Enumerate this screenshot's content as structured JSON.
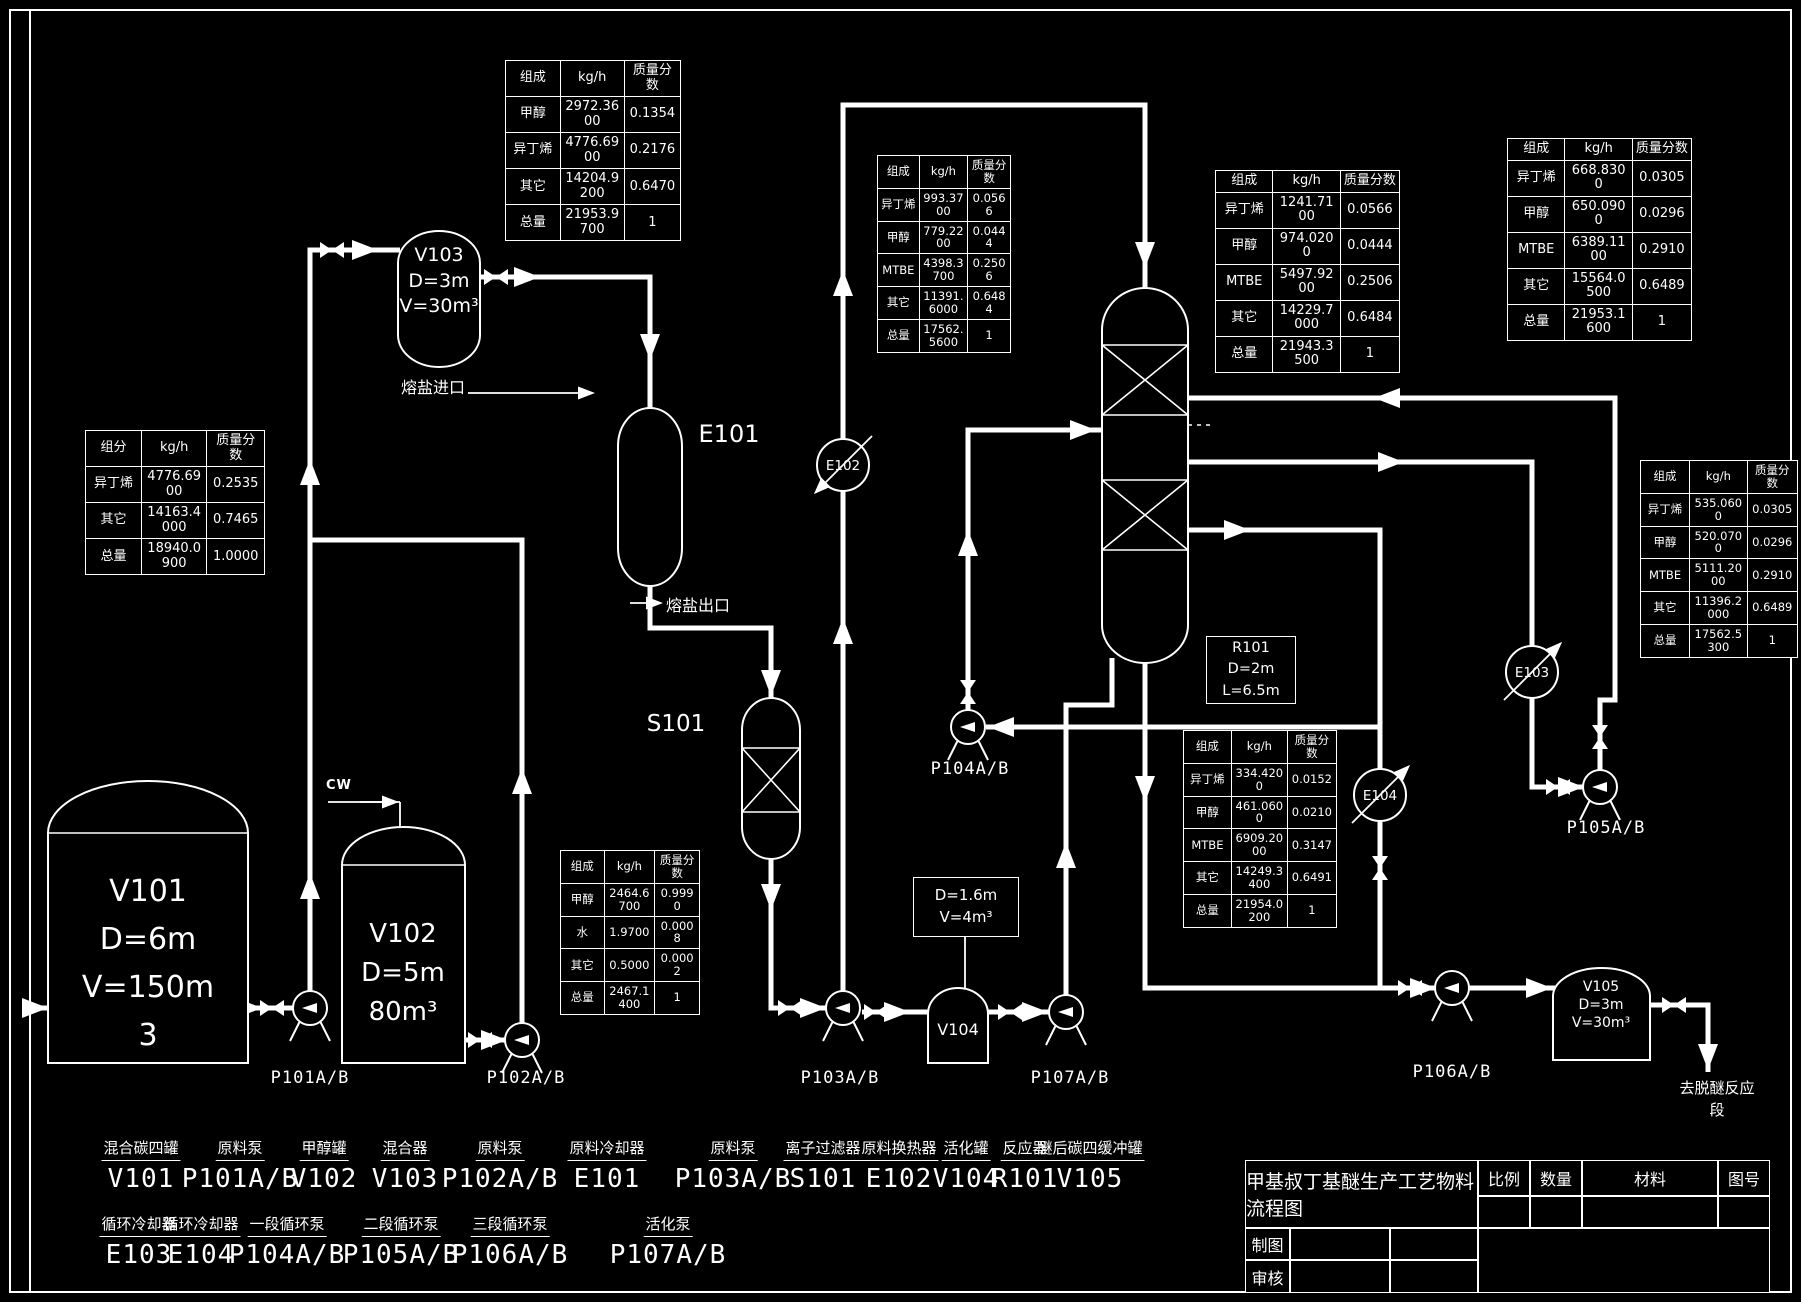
{
  "colors": {
    "background": "#000000",
    "line": "#ffffff"
  },
  "tables": {
    "top_center": {
      "headers": [
        "组成",
        "kg/h",
        "质量分数"
      ],
      "rows": [
        [
          "甲醇",
          "2972.3600",
          "0.1354"
        ],
        [
          "异丁烯",
          "4776.6900",
          "0.2176"
        ],
        [
          "其它",
          "14204.9200",
          "0.6470"
        ],
        [
          "总量",
          "21953.9700",
          "1"
        ]
      ]
    },
    "e102_stream": {
      "headers": [
        "组成",
        "kg/h",
        "质量分数"
      ],
      "rows": [
        [
          "异丁烯",
          "993.3700",
          "0.0566"
        ],
        [
          "甲醇",
          "779.2200",
          "0.0444"
        ],
        [
          "MTBE",
          "4398.3700",
          "0.2506"
        ],
        [
          "其它",
          "11391.6000",
          "0.6484"
        ],
        [
          "总量",
          "17562.5600",
          "1"
        ]
      ]
    },
    "r101_feed": {
      "headers": [
        "组成",
        "kg/h",
        "质量分数"
      ],
      "rows": [
        [
          "异丁烯",
          "1241.7100",
          "0.0566"
        ],
        [
          "甲醇",
          "974.0200",
          "0.0444"
        ],
        [
          "MTBE",
          "5497.9200",
          "0.2506"
        ],
        [
          "其它",
          "14229.7000",
          "0.6484"
        ],
        [
          "总量",
          "21943.3500",
          "1"
        ]
      ]
    },
    "top_right": {
      "headers": [
        "组成",
        "kg/h",
        "质量分数"
      ],
      "rows": [
        [
          "异丁烯",
          "668.8300",
          "0.0305"
        ],
        [
          "甲醇",
          "650.0900",
          "0.0296"
        ],
        [
          "MTBE",
          "6389.1100",
          "0.2910"
        ],
        [
          "其它",
          "15564.0500",
          "0.6489"
        ],
        [
          "总量",
          "21953.1600",
          "1"
        ]
      ]
    },
    "left_feed": {
      "headers": [
        "组分",
        "kg/h",
        "质量分数"
      ],
      "rows": [
        [
          "异丁烯",
          "4776.6900",
          "0.2535"
        ],
        [
          "其它",
          "14163.4000",
          "0.7465"
        ],
        [
          "总量",
          "18940.0900",
          "1.0000"
        ]
      ]
    },
    "right_mid": {
      "headers": [
        "组成",
        "kg/h",
        "质量分数"
      ],
      "rows": [
        [
          "异丁烯",
          "535.0600",
          "0.0305"
        ],
        [
          "甲醇",
          "520.0700",
          "0.0296"
        ],
        [
          "MTBE",
          "5111.2000",
          "0.2910"
        ],
        [
          "其它",
          "11396.2000",
          "0.6489"
        ],
        [
          "总量",
          "17562.5300",
          "1"
        ]
      ]
    },
    "r101_bottom": {
      "headers": [
        "组成",
        "kg/h",
        "质量分数"
      ],
      "rows": [
        [
          "异丁烯",
          "334.4200",
          "0.0152"
        ],
        [
          "甲醇",
          "461.0600",
          "0.0210"
        ],
        [
          "MTBE",
          "6909.2000",
          "0.3147"
        ],
        [
          "其它",
          "14249.3400",
          "0.6491"
        ],
        [
          "总量",
          "21954.0200",
          "1"
        ]
      ]
    },
    "methanol_feed": {
      "headers": [
        "组成",
        "kg/h",
        "质量分数"
      ],
      "rows": [
        [
          "甲醇",
          "2464.6700",
          "0.9990"
        ],
        [
          "水",
          "1.9700",
          "0.0008"
        ],
        [
          "其它",
          "0.5000",
          "0.0002"
        ],
        [
          "总量",
          "2467.1400",
          "1"
        ]
      ]
    }
  },
  "equipment": {
    "v101": "V101\nD=6m\nV=150m\n3",
    "v102": "V102\nD=5m\n80m³",
    "v103": "V103\nD=3m\nV=30m³",
    "e101": "E101",
    "s101": "S101",
    "e102": "E102",
    "e103": "E103",
    "e104": "E104",
    "r101_box": "R101\nD=2m\nL=6.5m",
    "v104": "V104",
    "v104_box": "D=1.6m\nV=4m³",
    "v105": "V105\nD=3m\nV=30m³",
    "p101": "P101A/B",
    "p102": "P102A/B",
    "p103": "P103A/B",
    "p104": "P104A/B",
    "p105": "P105A/B",
    "p106": "P106A/B",
    "p107": "P107A/B"
  },
  "streams": {
    "molten_salt_in": "熔盐进口",
    "molten_salt_out": "熔盐出口",
    "cooling_water": "CW",
    "to_deetherification": "去脱醚反应段"
  },
  "legend_row1": [
    {
      "name": "混合碳四罐",
      "code": "V101"
    },
    {
      "name": "原料泵",
      "code": "P101A/B"
    },
    {
      "name": "甲醇罐",
      "code": "V102"
    },
    {
      "name": "混合器",
      "code": "V103"
    },
    {
      "name": "原料泵",
      "code": "P102A/B"
    },
    {
      "name": "原料冷却器",
      "code": "E101"
    },
    {
      "name": "原料泵",
      "code": "P103A/B"
    },
    {
      "name": "离子过滤器",
      "code": "S101"
    },
    {
      "name": "原料换热器",
      "code": "E102"
    },
    {
      "name": "活化罐",
      "code": "V104"
    },
    {
      "name": "反应器",
      "code": "R101"
    },
    {
      "name": "醚后碳四缓冲罐",
      "code": "V105"
    }
  ],
  "legend_row2": [
    {
      "name": "循环冷却器",
      "code": "E103"
    },
    {
      "name": "循环冷却器",
      "code": "E104"
    },
    {
      "name": "一段循环泵",
      "code": "P104A/B"
    },
    {
      "name": "二段循环泵",
      "code": "P105A/B"
    },
    {
      "name": "三段循环泵",
      "code": "P106A/B"
    },
    {
      "name": "活化泵",
      "code": "P107A/B"
    }
  ],
  "title_block": {
    "title": "甲基叔丁基醚生产工艺物料流程图",
    "scale": "比例",
    "quantity": "数量",
    "material": "材料",
    "drawing_no": "图号",
    "drafter": "制图",
    "reviewer": "审核"
  }
}
